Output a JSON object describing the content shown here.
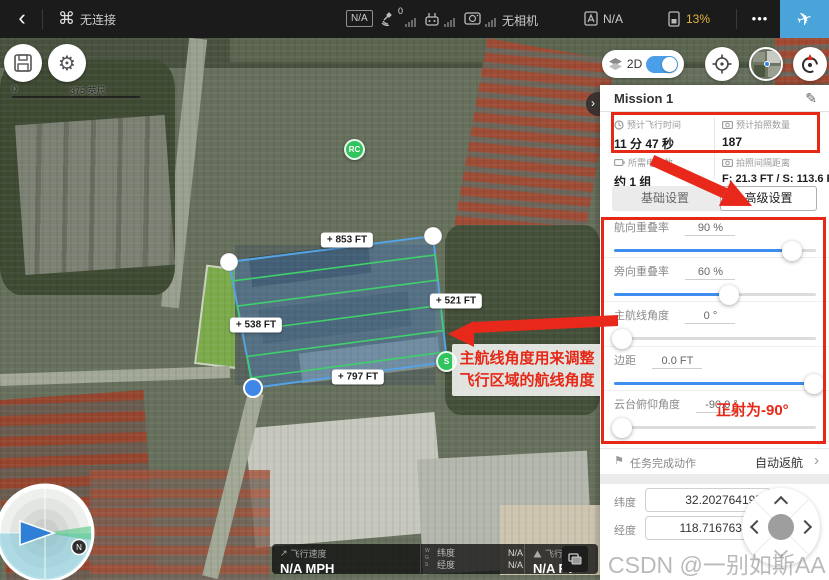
{
  "top_bar": {
    "back_icon": "‹",
    "aircraft_icon": "⌘",
    "connection_status": "无连接",
    "flight_mode_badge": "N/A",
    "gps_count": "0",
    "camera_status": "无相机",
    "rc_mode_value": "N/A",
    "battery_percent": "13%",
    "more_icon": "•••",
    "takeoff_icon": "✈"
  },
  "map_controls": {
    "scale_start": "0",
    "scale_end": "375 英尺",
    "view_mode": "2D",
    "gear_icon": "⚙"
  },
  "map": {
    "rc_marker": "RC",
    "start_marker": "S",
    "edge_label_top": "+ 853 FT",
    "edge_label_right": "+ 521 FT",
    "edge_label_left": "+ 538 FT",
    "edge_label_bottom": "+ 797 FT",
    "north_label": "N"
  },
  "annotations": {
    "route_angle_tip_line1": "主航线角度用来调整",
    "route_angle_tip_line2": "飞行区域的航线角度",
    "gimbal_note": "正射为-90°"
  },
  "panel": {
    "title": "Mission 1",
    "edit_icon": "✎",
    "collapse_icon": "›",
    "stats": [
      {
        "label": "预计飞行时间",
        "value": "11 分 47 秒"
      },
      {
        "label": "预计拍照数量",
        "value": "187"
      },
      {
        "label": "所需电池数",
        "value": "约 1 组"
      },
      {
        "label": "拍照间隔距离",
        "value": "F: 21.3 FT / S: 113.6 FT"
      }
    ],
    "tab_basic": "基础设置",
    "tab_advanced": "高级设置",
    "sliders": [
      {
        "label": "航向重叠率",
        "value": "90 %",
        "pos": 88
      },
      {
        "label": "旁向重叠率",
        "value": "60 %",
        "pos": 57
      },
      {
        "label": "主航线角度",
        "value": "0 °",
        "pos": 4
      },
      {
        "label": "边距",
        "value": "0.0 FT",
        "pos": 99
      },
      {
        "label": "云台俯仰角度",
        "value": "-90.0 °",
        "pos": 4
      }
    ],
    "finish_action": {
      "icon": "⚑",
      "label": "任务完成动作",
      "value": "自动返航",
      "chevron": "›"
    },
    "coords": {
      "lat_label": "纬度",
      "lat_value": "32.202764195",
      "lng_label": "经度",
      "lng_value": "118.716763493"
    }
  },
  "telemetry": {
    "speed_icon": "↗",
    "speed_label": "飞行速度",
    "speed_value": "N/A MPH",
    "wgs": [
      "W",
      "G",
      "S"
    ],
    "lat_label": "纬度",
    "lat_value": "N/A",
    "lng_label": "经度",
    "lng_value": "N/A",
    "alt_label": "飞行高度",
    "alt_value": "N/A FT"
  },
  "watermark": "CSDN @一别如斯AA",
  "colors": {
    "accent_blue": "#3e8ef0",
    "takeoff_blue": "#4aa3d9",
    "annotation_red": "#e62817",
    "battery_warning": "#e0b63e",
    "route_green": "#3fd06a",
    "polygon_blue": "#57a8e8"
  }
}
